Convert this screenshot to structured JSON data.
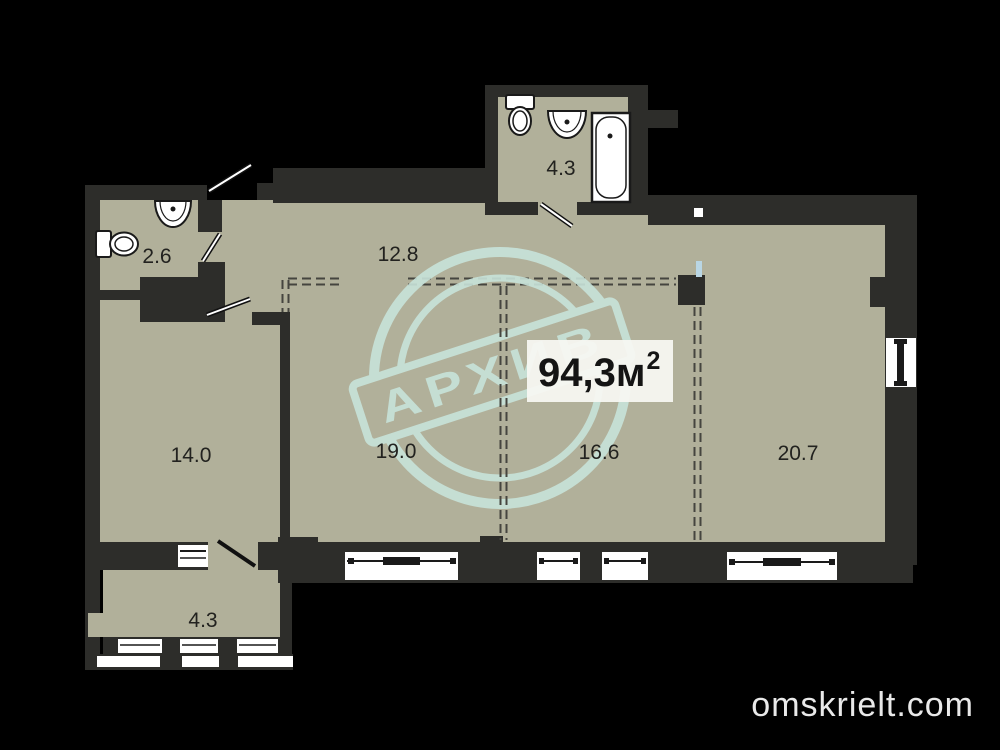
{
  "plan": {
    "type": "apartment-floor-plan",
    "rooms": [
      {
        "name": "wc",
        "area": "2.6"
      },
      {
        "name": "hallway",
        "area": "12.8"
      },
      {
        "name": "bathroom",
        "area": "4.3"
      },
      {
        "name": "room-left",
        "area": "14.0"
      },
      {
        "name": "room-mid-left",
        "area": "19.0"
      },
      {
        "name": "room-mid-right",
        "area": "16.6"
      },
      {
        "name": "room-right",
        "area": "20.7"
      },
      {
        "name": "balcony",
        "area": "4.3"
      }
    ],
    "total_area": {
      "value": "94,3м",
      "sup": "2"
    }
  },
  "watermark": {
    "stamp_text": "АРХИВ",
    "site_text": "omskrielt.com"
  },
  "colors": {
    "background": "#000000",
    "wall": "#2d2d2a",
    "floor": "#b1b09a",
    "window": "#ffffff",
    "stamp": "#c8e3da",
    "dashed_partition": "#45453f",
    "label_text": "#22221f",
    "site_text": "#e9e9e9"
  }
}
